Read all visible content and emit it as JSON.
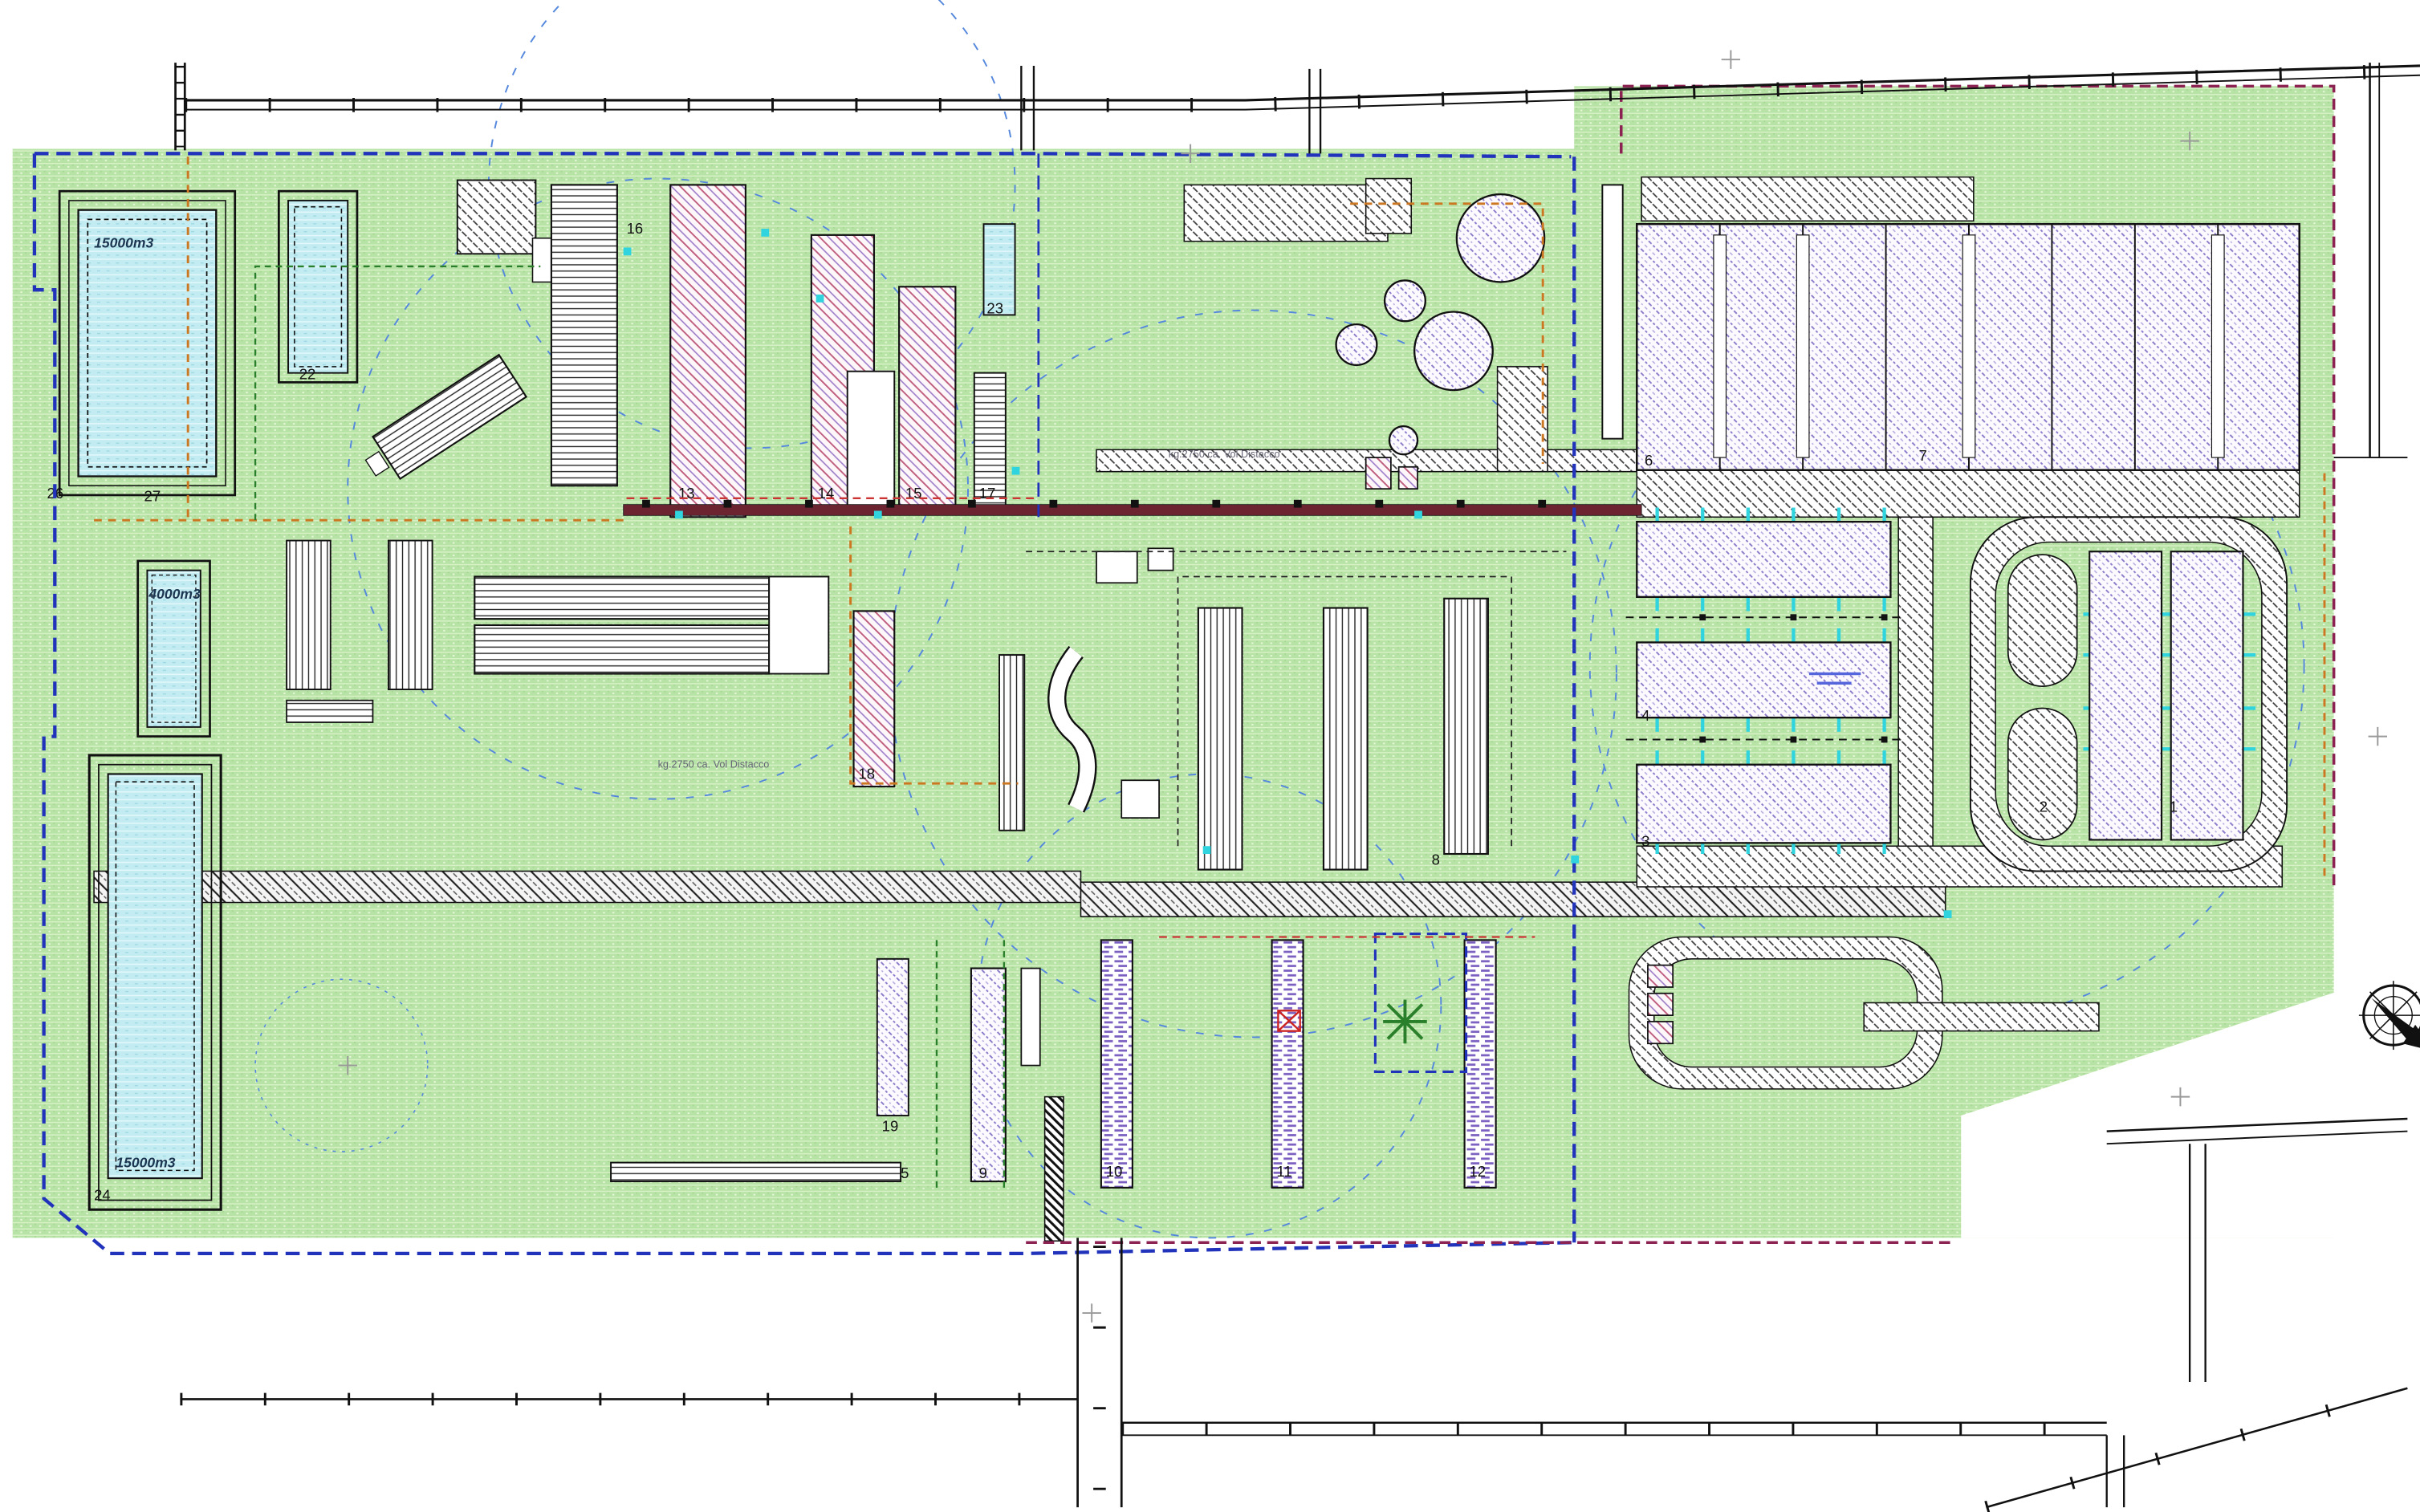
{
  "drawing": {
    "type": "site-plan",
    "labels": {
      "n1": "1",
      "n2": "2",
      "n3": "3",
      "n4": "4",
      "n5": "5",
      "n6": "6",
      "n7": "7",
      "n8": "8",
      "n9": "9",
      "n10": "10",
      "n11": "11",
      "n12": "12",
      "n13": "13",
      "n14": "14",
      "n15": "15",
      "n16": "16",
      "n17": "17",
      "n18": "18",
      "n19": "19",
      "n22": "22",
      "n23": "23",
      "n24": "24",
      "n26": "26",
      "n27": "27"
    },
    "volumes": {
      "basin_top": "15000m3",
      "basin_mid": "4000m3",
      "basin_bottom": "15000m3"
    },
    "annotations": {
      "note_top": "kg.2750 ca. Vol Distacco",
      "note_center": "kg.2750 ca. Vol Distacco"
    },
    "colors": {
      "grass": "#b8e3a6",
      "water": "#c2ecf2",
      "pink_hatch": "#c06080",
      "purple_hatch": "#8d7cc9",
      "road_line": "#333333",
      "boundary_blue": "#2233bb",
      "boundary_maroon": "#8b2252",
      "boundary_orange": "#cc7722",
      "pipe_band": "#6b2430",
      "cyan_marker": "#2fd4de",
      "radius_circle": "#5588dd",
      "hedge_green": "#2a7f2a"
    }
  }
}
